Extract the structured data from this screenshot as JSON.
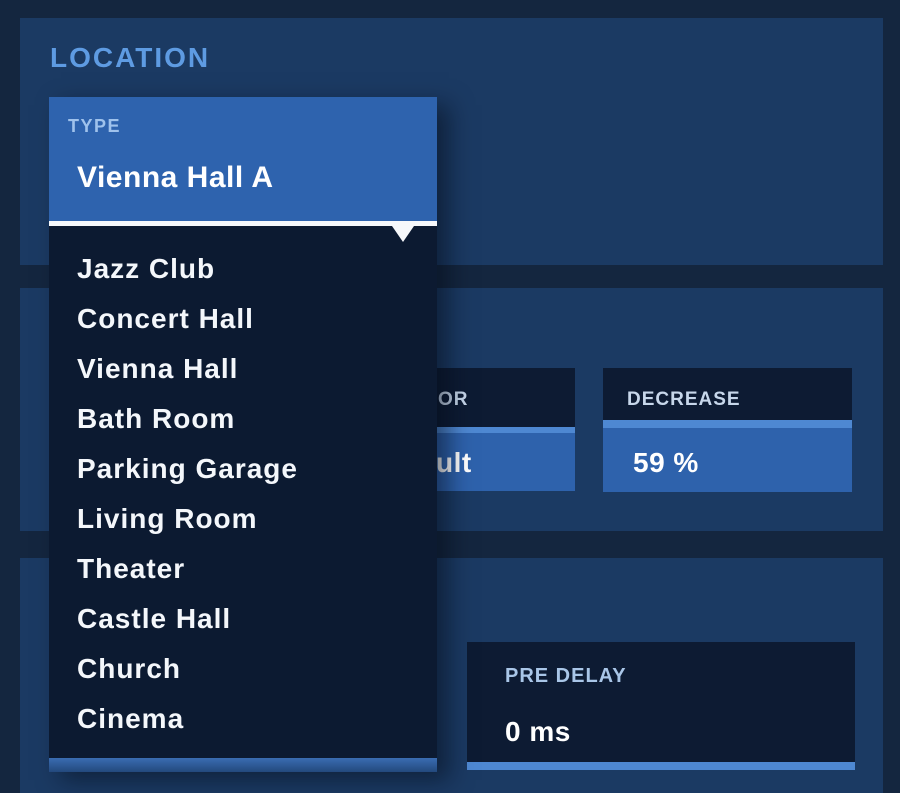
{
  "location_section": {
    "heading": "LOCATION",
    "type_dropdown": {
      "label": "TYPE",
      "selected_value": "Vienna Hall A",
      "options": [
        "Jazz Club",
        "Concert Hall",
        "Vienna Hall",
        "Bath Room",
        "Parking Garage",
        "Living Room",
        "Theater",
        "Castle Hall",
        "Church",
        "Cinema"
      ]
    }
  },
  "controls": {
    "clipped_control": {
      "partial_label_visible": "OR",
      "partial_value_visible": "ult"
    },
    "decrease": {
      "label": "DECREASE",
      "value": "59 %"
    },
    "pre_delay": {
      "label": "PRE DELAY",
      "value": "0 ms"
    }
  },
  "colors": {
    "background": "#14263F",
    "panel": "#1B3A63",
    "box_dark": "#0D1B33",
    "dropdown_list_bg": "#0C1A31",
    "accent_blue": "#2E63AE",
    "highlight_strip_blue": "#4E88D2",
    "heading_blue": "#5E9BE2",
    "type_label_blue": "#9FC2EC",
    "small_label_blue": "#C7D7EB",
    "predelay_label_blue": "#A9C6E8",
    "text_white": "#FFFFFF"
  }
}
